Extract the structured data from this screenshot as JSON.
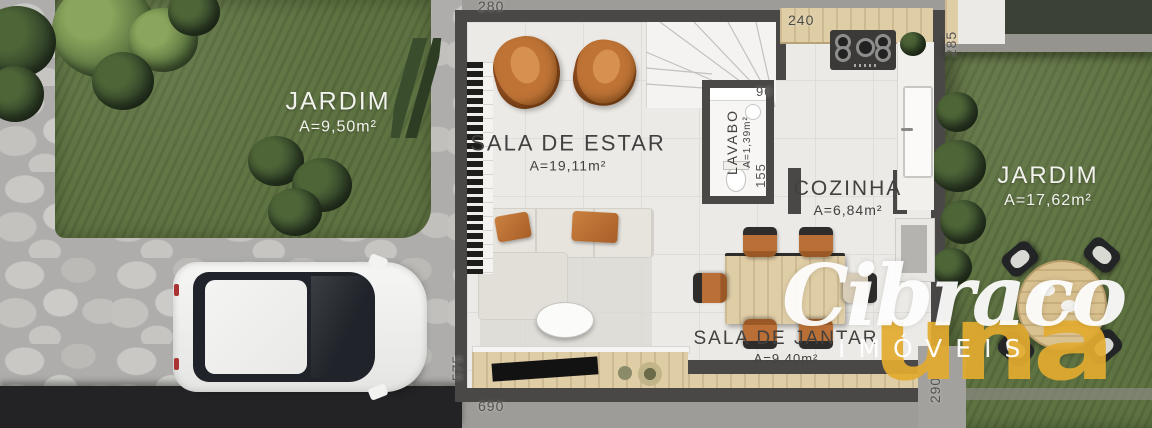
{
  "scene": {
    "kind": "floor-plan-render",
    "floor": "ground floor with gardens, stone driveway and parked car"
  },
  "rooms": [
    {
      "key": "garden-left",
      "name": "JARDIM",
      "area": "A=9,50m²"
    },
    {
      "key": "living-room",
      "name": "SALA DE ESTAR",
      "area": "A=19,11m²"
    },
    {
      "key": "powder-room",
      "name": "LAVABO",
      "area": "A=1,39m²"
    },
    {
      "key": "kitchen",
      "name": "COZINHA",
      "area": "A=6,84m²"
    },
    {
      "key": "dining-room",
      "name": "SALA DE JANTAR",
      "area": "A=9,40m²"
    },
    {
      "key": "garden-right",
      "name": "JARDIM",
      "area": "A=17,62m²"
    }
  ],
  "dimensions_cm": [
    {
      "key": "top-left-width",
      "value": "280"
    },
    {
      "key": "kitchen-top-width",
      "value": "240"
    },
    {
      "key": "right-upper-depth",
      "value": "285"
    },
    {
      "key": "lavabo-width",
      "value": "90"
    },
    {
      "key": "lavabo-depth",
      "value": "155"
    },
    {
      "key": "left-lower-depth",
      "value": "575"
    },
    {
      "key": "bottom-width",
      "value": "690"
    },
    {
      "key": "right-lower-depth",
      "value": "290"
    }
  ],
  "watermark": {
    "brand": "Cibraco",
    "brand_sub": "una",
    "tagline": "IMÓVEIS"
  },
  "colors": {
    "accent_gold": "#e2ab2f",
    "grass": "#5f7342",
    "wall": "#4a4846",
    "wood": "#ddcba4",
    "chair_orange": "#b96f35",
    "floor": "#eceae6",
    "stone": "#b3b2ae",
    "road": "#232326",
    "watermark_white": "#ffffff"
  }
}
